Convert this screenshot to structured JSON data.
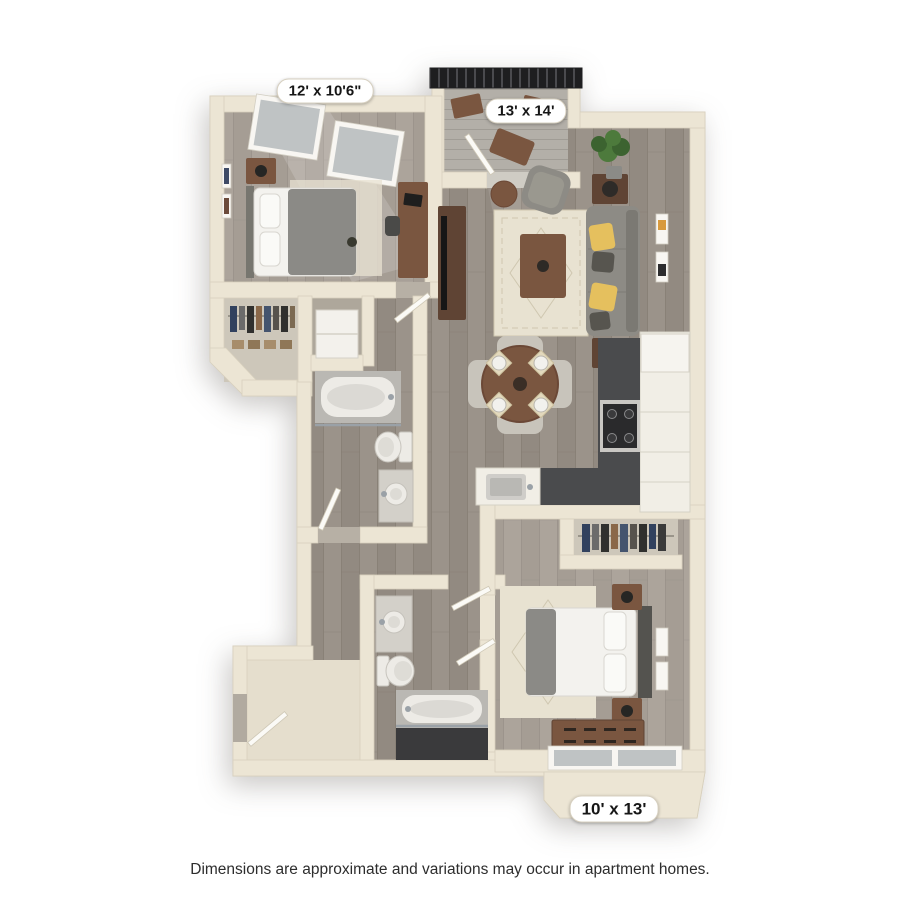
{
  "labels": {
    "bedroom1": {
      "text": "12' x 10'6\""
    },
    "living": {
      "text": "13' x 14'"
    },
    "bedroom2": {
      "text": "10' x 13'"
    }
  },
  "footer": {
    "disclaimer": "Dimensions are approximate and variations may occur in apartment homes."
  },
  "colors": {
    "background": "#ffffff",
    "wall": "#ece5d4",
    "wallEdge": "#d8d0bd",
    "floorWood": "#928a81",
    "floorWoodAlt": "#9b938a",
    "plankLine": "#7f776e",
    "floorLightA": "#a59d94",
    "floorLightB": "#aca49b",
    "plankLineLight": "#948c83",
    "entryFloor": "#e5decd",
    "balconyFloor": "#b3afa8",
    "balconySlat": "#a09c95",
    "railing": "#1e1e20",
    "railingSlat": "#4a4a4e",
    "counterDark": "#4a4b4d",
    "cabinetWhite": "#f1eee6",
    "cabinetLine": "#d5d1c5",
    "sofaGray": "#8d8b85",
    "sofaDark": "#7b7973",
    "pillowYellow": "#e5c05e",
    "pillowDark": "#57554f",
    "woodBrown": "#7a5640",
    "woodDark": "#5f4434",
    "bedWhite": "#f3f2ee",
    "blanketGray": "#8b8a86",
    "headboard": "#54534f",
    "rugCream": "#e8e2d1",
    "rugPattern": "#cfc7b0",
    "plantGreen": "#4d7a3c",
    "plantDark": "#3c6330",
    "fixtureWhite": "#edebe6",
    "fixtureLine": "#c7c4bd",
    "tubDeck": "#bab8b3",
    "tubFront": "#3a3a3c",
    "chrome": "#9aa1a7",
    "glass": "#bfc3c4",
    "frameWhite": "#f8f6f2",
    "closetBack": "#cdc7ba",
    "clothesNavy": "#31415e",
    "clothesGray": "#6b6b6b",
    "clothesDark": "#30302e",
    "clothesBrown": "#8a6849",
    "applianceWhite": "#f3f1ec",
    "lampDark": "#262624",
    "artOrange": "#d89a3e",
    "doorWhite": "#fbfaf6",
    "doorEdge": "#cfc8b6",
    "labelBg": "#ffffff",
    "labelText": "#161616",
    "labelBorder": "#d7d0c0",
    "footerText": "#2d2d2d"
  }
}
